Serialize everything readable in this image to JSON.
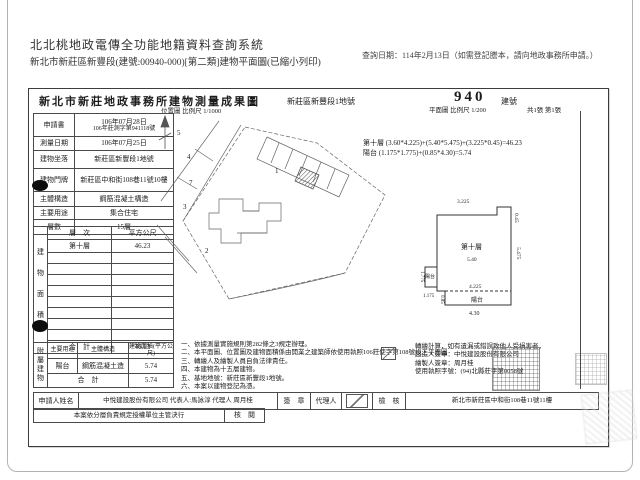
{
  "header": {
    "system_title": "北北桃地政電傳全功能地籍資料查詢系統",
    "subtitle": "新北市新莊區新豐段(建號:00940-000)[第二類]建物平面圖(已縮小列印)",
    "query_date": "查詢日期：114年2月13日（如需登記謄本，請向地政事務所申請。）"
  },
  "doc": {
    "title": "新北市新莊地政事務所建物測量成果圖",
    "parcel_label": "新莊區新豐段1地號",
    "building_no": "940",
    "building_no_label": "建號",
    "map_scale": "位置圖 比例尺 1/1000",
    "plan_scale": "平面圖 比例尺 1/200",
    "sheet_info": "共1張 第1張",
    "info_rows": [
      {
        "label": "申請書",
        "value": "106年07月28日",
        "value2": "106年莊測字第941118號"
      },
      {
        "label": "測量日期",
        "value": "106年07月25日"
      },
      {
        "label": "建物坐落",
        "value": "新莊區新豐段1地號"
      },
      {
        "label": "建物門牌",
        "value": "新莊區中和街108巷11號10樓"
      },
      {
        "label": "主體構造",
        "value": "鋼筋混凝土構造"
      },
      {
        "label": "主要用途",
        "value": "集合住宅"
      },
      {
        "label": "層數",
        "value": "15層"
      }
    ],
    "area_table": {
      "side_label": "建物面積",
      "col_floor": "層　次",
      "col_area": "平方公尺",
      "floor": "第十層",
      "floor_area": "46.23",
      "total_label": "合　計",
      "total": "46.23"
    },
    "annex_table": {
      "side_label": "附屬建物",
      "col_use": "主要用途",
      "col_structure": "主體構造",
      "col_area": "建物面積(平方公尺)",
      "use": "陽台",
      "structure": "鋼筋混凝土造",
      "area": "5.74",
      "total_label": "合　計",
      "total": "5.74"
    },
    "calc_line1": "第十層 (3.60*4.225)+(5.40*5.475)+(3.225*0.45)=46.23",
    "calc_line2": "陽台 (1.175*1.775)+(0.85*4.30)=5.74",
    "notes": [
      "一、依據測量實施規則第282條之3規定辦理。",
      "二、本平面圖、位置圖及建物面積係由開業之建築師依使用執照106莊使字第108號竣工平面圖",
      "三、轉繪人及繪製人員自負法律責任。",
      "四、本建物為十五層建物。",
      "五、基地地號：新莊區新豐段1地號。",
      "六、本案以建物登記為憑。"
    ],
    "notes_right": [
      "轉繪計算，如有遺漏或錯誤致他人受損害者，",
      "起造人簽章：中悅建設股份有限公司",
      "繪製人簽章：周月桂",
      "使用執照字號：(94)北縣莊字第0058號"
    ],
    "applicant": {
      "label": "申請人姓名",
      "value": "中悅建設股份有限公司 代表人:馬詠淳 代理人 周月桂",
      "sign_label": "簽　章",
      "agent_label": "代理人",
      "check_label": "檢　核",
      "office": "新北市新莊區中和街108巷11號11樓"
    },
    "approval": {
      "text": "本案依分層負責規定授權單位主管決行",
      "check_label": "核　閱"
    },
    "plan": {
      "room_label": "第十層",
      "room_width": "5.40",
      "top_width": "3.225",
      "notch_height": "0.45",
      "right_height": "5.475",
      "balcony_label": "陽台",
      "balcony_w": "1.175",
      "balcony_h": "1.775",
      "mid_width": "4.225",
      "bottom_balcony_label": "陽台",
      "bottom_balcony_h": "0.85",
      "bottom_width": "4.30"
    },
    "map": {
      "parcels": [
        "5",
        "4",
        "7",
        "3",
        "1",
        "2"
      ]
    }
  }
}
